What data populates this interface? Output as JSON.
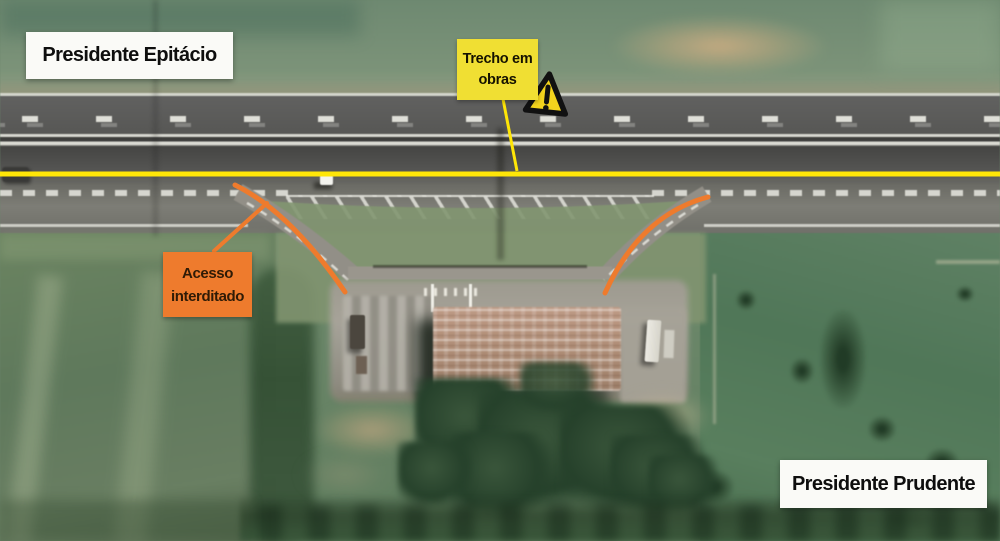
{
  "scene": {
    "type": "aerial-satellite-photo",
    "subject": "divided highway with closed access ramps to a roadside facility"
  },
  "labels": {
    "city_top_left": "Presidente Epitácio",
    "city_bottom_right": "Presidente Prudente",
    "roadworks": {
      "line1": "Trecho em",
      "line2": "obras"
    },
    "closed_access": {
      "line1": "Acesso",
      "line2": "interditado"
    }
  },
  "icons": {
    "warning": "warning-triangle-icon"
  },
  "colors": {
    "annotation_yellow": "#ffe607",
    "signbox_yellow": "#f0df33",
    "triangle_yellow": "#f2d31d",
    "annotation_orange": "#ee7b2d",
    "orange_text": "#2f1b06",
    "label_bg": "#fafaf7",
    "label_text": "#0e0e0e"
  }
}
